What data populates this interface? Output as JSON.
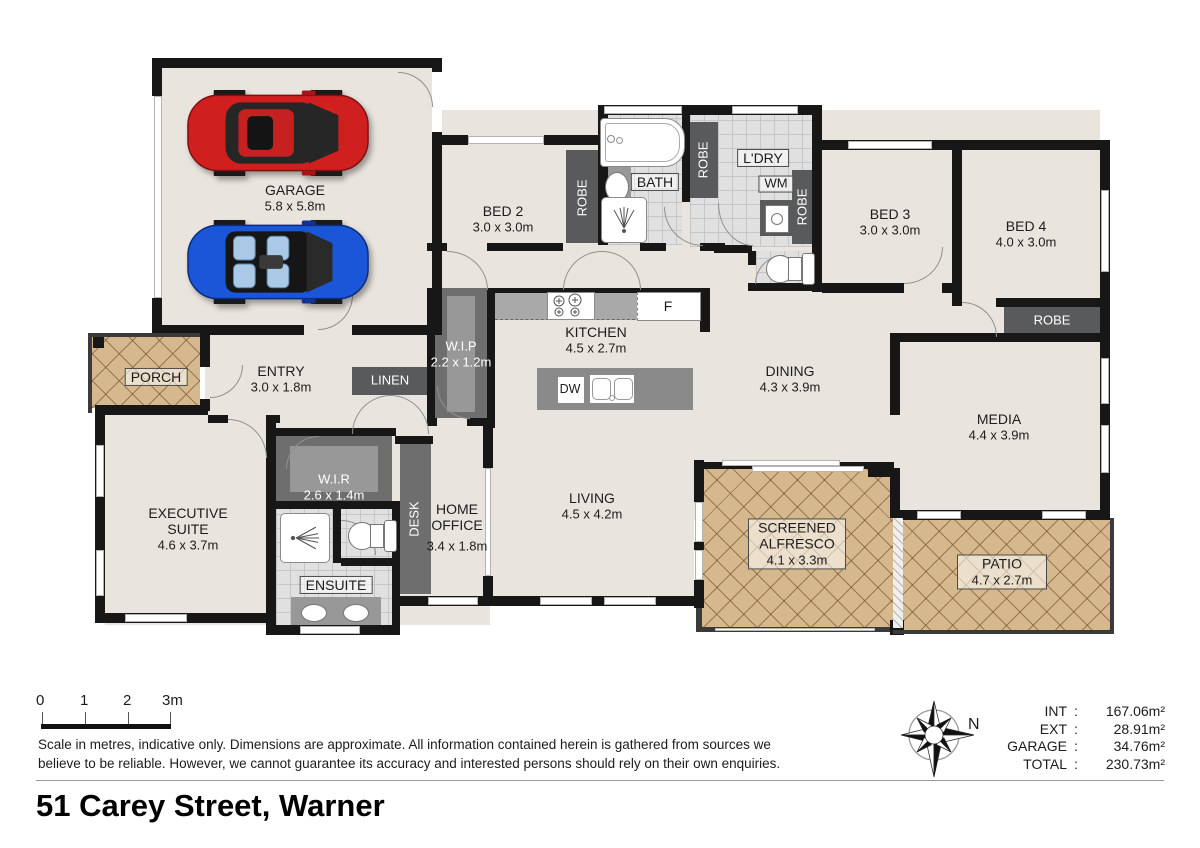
{
  "page": {
    "title": "51 Carey Street, Warner"
  },
  "footer": {
    "disclaimer_line1": "Scale in metres, indicative only. Dimensions are approximate. All information contained herein is gathered from sources we",
    "disclaimer_line2": "believe to be reliable. However, we cannot guarantee its accuracy and interested persons should rely on their own enquiries.",
    "scale_ticks": [
      "0",
      "1",
      "2",
      "3m"
    ],
    "compass_label": "N",
    "areas": {
      "rows": [
        {
          "label": "INT",
          "sep": ":",
          "value": "167.06m²"
        },
        {
          "label": "EXT",
          "sep": ":",
          "value": "28.91m²"
        },
        {
          "label": "GARAGE",
          "sep": ":",
          "value": "34.76m²"
        },
        {
          "label": "TOTAL",
          "sep": ":",
          "value": "230.73m²"
        }
      ]
    }
  },
  "rooms": {
    "garage": {
      "name": "GARAGE",
      "dims": "5.8 x 5.8m"
    },
    "bed2": {
      "name": "BED 2",
      "dims": "3.0 x 3.0m"
    },
    "bed3": {
      "name": "BED 3",
      "dims": "3.0 x 3.0m"
    },
    "bed4": {
      "name": "BED 4",
      "dims": "4.0 x 3.0m"
    },
    "bath": {
      "name": "BATH"
    },
    "ldry": {
      "name": "L'DRY"
    },
    "wm": {
      "name": "WM"
    },
    "robe": {
      "name": "ROBE"
    },
    "kitchen": {
      "name": "KITCHEN",
      "dims": "4.5 x 2.7m"
    },
    "fridge": {
      "name": "F"
    },
    "dw": {
      "name": "DW"
    },
    "wip": {
      "name": "W.I.P",
      "dims": "2.2 x 1.2m"
    },
    "linen": {
      "name": "LINEN"
    },
    "entry": {
      "name": "ENTRY",
      "dims": "3.0 x 1.8m"
    },
    "porch": {
      "name": "PORCH"
    },
    "dining": {
      "name": "DINING",
      "dims": "4.3 x 3.9m"
    },
    "media": {
      "name": "MEDIA",
      "dims": "4.4 x 3.9m"
    },
    "living": {
      "name": "LIVING",
      "dims": "4.5 x 4.2m"
    },
    "wir": {
      "name": "W.I.R",
      "dims": "2.6 x 1.4m"
    },
    "desk": {
      "name": "DESK"
    },
    "home_office": {
      "name": "HOME OFFICE",
      "dims": "3.4 x 1.8m"
    },
    "executive_suite": {
      "name": "EXECUTIVE SUITE",
      "dims": "4.6 x 3.7m"
    },
    "ensuite": {
      "name": "ENSUITE"
    },
    "alfresco": {
      "name": "SCREENED ALFRESCO",
      "dims": "4.1 x 3.3m"
    },
    "patio": {
      "name": "PATIO",
      "dims": "4.7 x 2.7m"
    }
  },
  "colors": {
    "wall": "#171717",
    "floor": "#e9e5de",
    "tile": "#e0e0e0",
    "cabinetry_dark": "#595a5c",
    "cabinetry_mid": "#6e6e6e",
    "outdoor_tan": "#d6b88e",
    "car_red": "#cf1f1f",
    "car_blue": "#1b55d8"
  }
}
